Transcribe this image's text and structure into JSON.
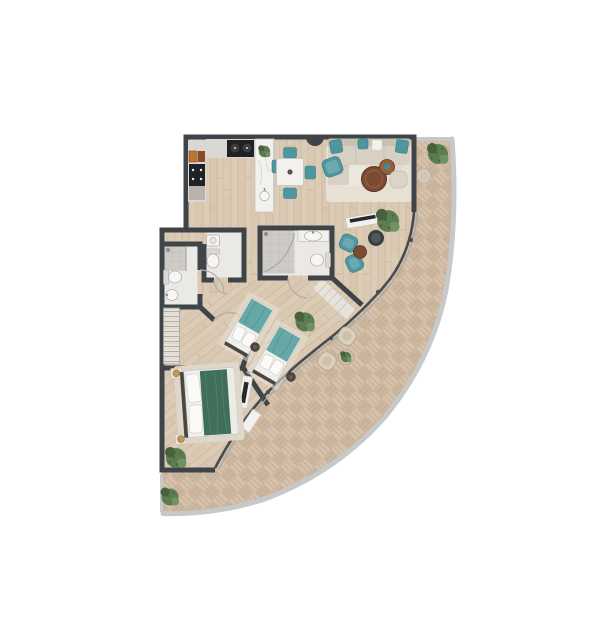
{
  "meta": {
    "title": "apartment-floor-plan-with-curved-terrace"
  },
  "palette": {
    "wall": "#3f4449",
    "wood": "#dccbb5",
    "woodLine": "#cbb9a1",
    "tile": "#d6c2ac",
    "tileLine": "#c2aa91",
    "tileAlt": "#ccb69e",
    "rim": "#c6c8c9",
    "bathFloor": "#ebe9e6",
    "bathTile": "#cecbc6",
    "bathTileLine": "#bcb9b3",
    "glassDark": "#474c51",
    "glassLight": "#a3a8ac",
    "white": "#f2f1ee",
    "whiteStroke": "#c8c4be",
    "teal": "#4e96a0",
    "tealDark": "#3c7d87",
    "tealLight": "#6ca8b0",
    "twinTeal": "#66a8a6",
    "twinTealFold": "#549190",
    "bedGreen": "#3f6e5b",
    "bedGreenFold": "#4e816a",
    "sofa": "#d8d1c3",
    "sofaBack": "#c8c0b0",
    "sofaSeam": "#c4bcac",
    "rug": "#e6e0d5",
    "rugMaster": "#ded7ca",
    "runner": "#e8e3da",
    "runnerLine": "#cfc8bb",
    "brown": "#7b4b33",
    "brownLight": "#95603f",
    "brownDark": "#5a3524",
    "bowlTeal": "#3f8d96",
    "plant": "#5c7d50",
    "plantDark": "#46613c",
    "plantLight": "#6f9263",
    "gold": "#c09a50",
    "goldDark": "#9a7a3c",
    "dark": "#3b3f43",
    "darkInner": "#52575c",
    "wicker": "#d9d0bf",
    "wickerStroke": "#b7a98e",
    "wickerInner": "#cdc1ab",
    "counter": "#dbd8d3",
    "applianceOrange": "#bd7434",
    "applianceDark": "#8a4a28",
    "black": "#202124",
    "grayCounter": "#b8b4ad",
    "burner": "#3a3c3e",
    "fixture": "#f7f6f4",
    "fixtureStroke": "#b3afa9",
    "tank": "#dcd9d4",
    "doorArc": "#b3afa9",
    "headboard": "#4a4642",
    "pillow": "#fbfaf8",
    "pillowStroke": "#cfcbc5",
    "bedFrame": "#f1efeb",
    "bedFrameStroke": "#c9c5bf",
    "nightstand": "#eae5dc",
    "nightstandStroke": "#c6c1b8",
    "wardrobeBase": "#e9e5de",
    "wardrobeLine": "#b4aea4",
    "wardrobeStroke": "#a9a49b",
    "shadowRug": "#eae3d7",
    "stool": "#4f443c",
    "stoolInner": "#6b5c4d",
    "tvBlack": "#26282a",
    "metal": "#8e8a84",
    "pouf": "#dbd4c7",
    "poufStroke": "#c6beac",
    "whitePillow": "#f4f2ed",
    "footStrip": "#edebe7",
    "tableSide": "#d6cdbc",
    "tableSideStroke": "#bdb096",
    "marbleVein": "#d8d5d0"
  },
  "scene": {
    "background": "#ffffff",
    "canvas": {
      "width": 604,
      "height": 640
    },
    "rooms": [
      {
        "name": "kitchen"
      },
      {
        "name": "dining-area"
      },
      {
        "name": "living-room"
      },
      {
        "name": "entry-hall"
      },
      {
        "name": "bathroom-1"
      },
      {
        "name": "bathroom-2"
      },
      {
        "name": "bathroom-3"
      },
      {
        "name": "twin-bedroom"
      },
      {
        "name": "master-bedroom"
      },
      {
        "name": "curved-terrace"
      }
    ],
    "furniture": [
      {
        "room": "kitchen",
        "items": [
          "appliance-column",
          "cooktop-counter",
          "island-with-sink",
          "island-plant"
        ]
      },
      {
        "room": "dining-area",
        "items": [
          "square-table",
          "four-teal-chairs"
        ]
      },
      {
        "room": "living-room",
        "items": [
          "sofa-with-teal-pillows",
          "chaise",
          "teal-armchair",
          "round-coffee-tables",
          "pouf",
          "rug",
          "tv-console",
          "large-plant",
          "dark-lounge-chair",
          "two-teal-reading-chairs",
          "round-side-table"
        ]
      },
      {
        "room": "bathroom-1",
        "items": [
          "shower",
          "toilet",
          "sink"
        ]
      },
      {
        "room": "bathroom-2",
        "items": [
          "sink",
          "toilet"
        ]
      },
      {
        "room": "bathroom-3",
        "items": [
          "shower",
          "vanity-sink",
          "toilet"
        ]
      },
      {
        "room": "twin-bedroom",
        "items": [
          "twin-bed-1",
          "twin-bed-2",
          "round-stools",
          "plant",
          "dressers",
          "wardrobe",
          "runner-rug"
        ]
      },
      {
        "room": "master-bedroom",
        "items": [
          "double-bed-green-duvet",
          "nightstands-with-lamps",
          "rug",
          "plant"
        ]
      },
      {
        "room": "curved-terrace",
        "items": [
          "two-wicker-chairs",
          "round-plant-table",
          "side-table",
          "plants"
        ]
      }
    ]
  }
}
